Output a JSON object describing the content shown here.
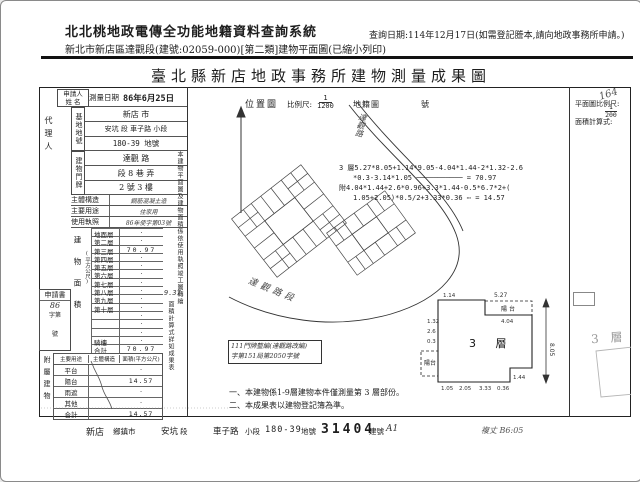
{
  "header": {
    "system_title": "北北桃地政電傳全功能地籍資料查詢系統",
    "doc_line": "新北市新店區達觀段(建號:02059-000)[第二類]建物平面圖(已縮小列印)",
    "query_date": "查詢日期:114年12月17日(如需登記謄本,請向地政事務所申請。)"
  },
  "form": {
    "title": "臺北縣新店地政事務所建物測量成果圖",
    "corner_mark": "164",
    "applicant_label_1": "申請人",
    "applicant_label_2": "姓 名",
    "agent_label": "代理人",
    "survey_date_label": "測量日期",
    "survey_date_value": "86年6月25日",
    "site_label": "基地地號",
    "site_city": "新店 市",
    "site_section": "安坑 段 車子路 小段",
    "site_parcel": "180-39 地號",
    "addr_label": "建物門牌",
    "addr_street": "達觀 路",
    "addr_lane": "段 8 巷 弄",
    "addr_no": "2 號 3 樓",
    "structure_label": "主體構造",
    "structure_value": "鋼筋混凝土造",
    "usage_label": "主要用途",
    "usage_value": "住家用",
    "license_label": "使用執照",
    "license_value": "86年使字第03號",
    "area_table": {
      "label": "建物面積",
      "unit": "(平方公尺)",
      "rows": [
        {
          "label": "地面層",
          "value": "·"
        },
        {
          "label": "第二層",
          "value": "·"
        },
        {
          "label": "第三層",
          "value": "70.97"
        },
        {
          "label": "第四層",
          "value": "·"
        },
        {
          "label": "第五層",
          "value": "·"
        },
        {
          "label": "第六層",
          "value": "·"
        },
        {
          "label": "第七層",
          "value": "·"
        },
        {
          "label": "第八層",
          "value": "·"
        },
        {
          "label": "第九層",
          "value": "·"
        },
        {
          "label": "第十層",
          "value": "·"
        },
        {
          "label": "",
          "value": "·"
        },
        {
          "label": "",
          "value": "·"
        },
        {
          "label": "",
          "value": "·"
        },
        {
          "label": "騎樓",
          "value": "·"
        }
      ],
      "total_label": "合計",
      "total_value": "70.97",
      "margin_note": "9.37"
    },
    "application_box": {
      "title": "申請書",
      "line1": "86",
      "line2": "字第",
      "line3": "號"
    },
    "annex_table": {
      "label": "附屬建物",
      "headers": [
        "主要用途",
        "主體構造",
        "面積(平方公尺)"
      ],
      "rows": [
        {
          "use": "平台",
          "area": "·"
        },
        {
          "use": "陽台",
          "area": "14.57"
        },
        {
          "use": "雨遮",
          "area": "·"
        },
        {
          "use": "其他",
          "area": "·"
        }
      ],
      "total_label": "合計",
      "total_value": "14.57"
    },
    "side_note_1": "本建物平面圖及建物面積係依使用執照竣工圖轉繪",
    "side_note_2": "面積計算式詳如成果表",
    "location_map": {
      "label": "位置圖",
      "scale_label": "比例尺:",
      "scale_num": "1",
      "scale_den": "1200",
      "ref_label": "地籍圖",
      "ref_no_label": "號",
      "road_label": "達觀路段",
      "road_label_2": "達觀路"
    },
    "formula": {
      "line1": "3 層5.27*8.05+1.14*9.05-4.04*1.44-2*1.32-2.6",
      "line2": "*0.3-3.14*1.05 ─────────── = 70.97",
      "line3": "附4.04*1.44+2.6*0.96+3.3*1.44-0.5*6.7*2+(",
      "line4": "1.05+2.05)*0.5/2+3.33*0.36 ⋯ = 14.57"
    },
    "boxed_note": {
      "line1": "111門牌整編(達觀路改編)",
      "line2": "字第151局第2050字號"
    },
    "notes": [
      "一、本建物係1-9層建物本件僅測量第 3 層部份。",
      "二、本成果表以建物登記簿為準。"
    ],
    "plan": {
      "scale_label": "平面圖比例尺:",
      "scale_num": "1",
      "scale_den": "200",
      "formula_label": "面積計算式:",
      "floor_label": "3 層",
      "balcony_label": "陽台",
      "balcony_label_2": "陽台",
      "ghost_label": "3 層",
      "dims": {
        "d1": "5.27",
        "d2": "1.14",
        "d3": "4.04",
        "d4": "8.05",
        "d5": "1.44",
        "d6": "1.32",
        "d7": "2.6",
        "d8": "0.3",
        "d9": "1.05",
        "d10": "2.05",
        "d11": "3.33",
        "d12": "0.36"
      }
    },
    "footer": {
      "city_value": "新店",
      "city_label": "鄉鎮市",
      "sect_value": "安坑",
      "sect_label": "段",
      "subsect_value": "車子路",
      "subsect_label": "小段",
      "parcel_value": "180-39",
      "parcel_label": "地號",
      "bldg_value": "31404",
      "bldg_label": "建號",
      "bldg_suffix": "A1",
      "check_note": "複丈 B6:05"
    }
  }
}
